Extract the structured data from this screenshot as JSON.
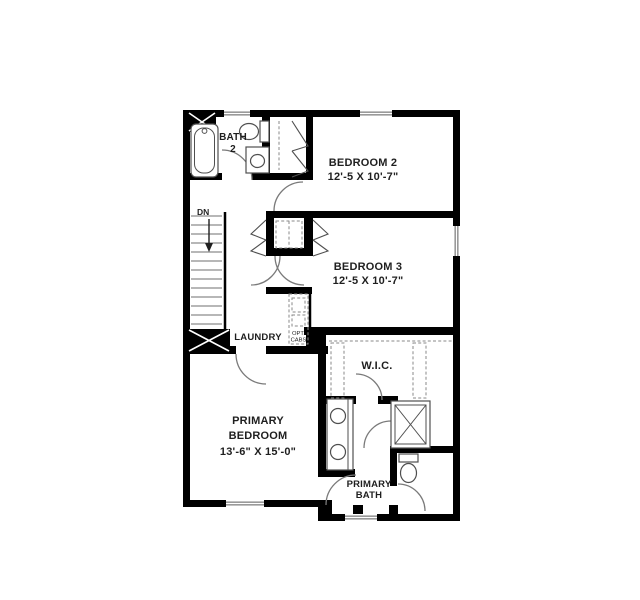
{
  "floorplan": {
    "rooms": {
      "bath2": {
        "line1": "BATH",
        "line2": "2"
      },
      "bedroom2": {
        "name": "BEDROOM 2",
        "dims": "12'-5 X 10'-7\""
      },
      "bedroom3": {
        "name": "BEDROOM 3",
        "dims": "12'-5 X 10'-7\""
      },
      "laundry": {
        "name": "LAUNDRY"
      },
      "wic": {
        "name": "W.I.C."
      },
      "primary_bedroom": {
        "line1": "PRIMARY",
        "line2": "BEDROOM",
        "dims": "13'-6\" X 15'-0\""
      },
      "primary_bath": {
        "line1": "PRIMARY",
        "line2": "BATH"
      }
    },
    "annotations": {
      "stairs_direction": "DN",
      "opt_cabs_line1": "OPT.",
      "opt_cabs_line2": "CABS"
    },
    "colors": {
      "wall": "#000000",
      "window_frame": "#9a9a9a",
      "door_arc": "#7a7a7a",
      "fixture": "#4f4f4f",
      "label_text": "#1f1f1f"
    }
  }
}
